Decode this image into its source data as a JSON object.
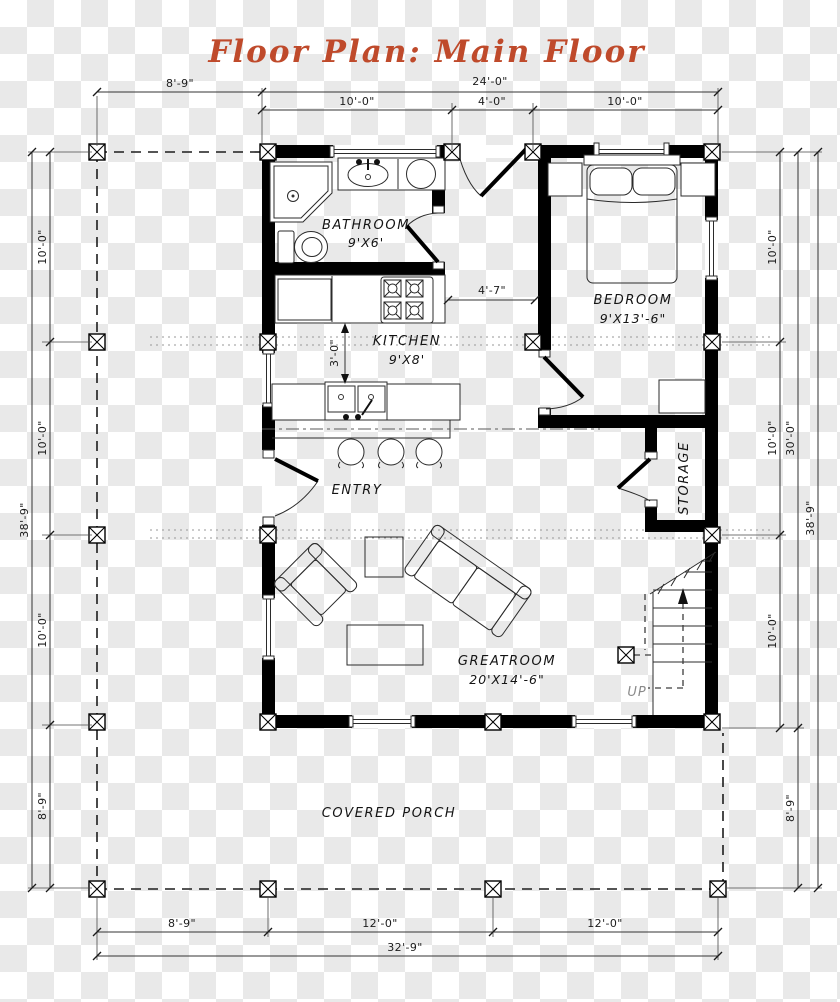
{
  "title": "Floor Plan: Main Floor",
  "colors": {
    "title": "#bf4a2b",
    "wall": "#000000"
  },
  "rooms": {
    "bathroom": {
      "name": "BATHROOM",
      "size": "9'X6'"
    },
    "kitchen": {
      "name": "KITCHEN",
      "size": "9'X8'"
    },
    "bedroom": {
      "name": "BEDROOM",
      "size": "9'X13'-6\""
    },
    "entry": {
      "name": "ENTRY"
    },
    "storage": {
      "name": "STORAGE"
    },
    "greatroom": {
      "name": "GREATROOM",
      "size": "20'X14'-6\""
    },
    "porch": {
      "name": "COVERED PORCH"
    }
  },
  "stairs": {
    "label": "UP"
  },
  "dims": {
    "top_porch": "8'-9\"",
    "top_total": "24'-0\"",
    "top_seg1": "10'-0\"",
    "top_seg2": "4'-0\"",
    "top_seg3": "10'-0\"",
    "hall_width": "4'-7\"",
    "island_clearance": "3'-0\"",
    "left_seg1": "10'-0\"",
    "left_seg2": "10'-0\"",
    "left_seg3": "10'-0\"",
    "left_porch": "8'-9\"",
    "left_total": "38'-9\"",
    "right_seg1": "10'-0\"",
    "right_seg2": "10'-0\"",
    "right_seg3": "10'-0\"",
    "right_house": "30'-0\"",
    "right_porch": "8'-9\"",
    "right_total": "38'-9\"",
    "bottom_seg1": "8'-9\"",
    "bottom_seg2": "12'-0\"",
    "bottom_seg3": "12'-0\"",
    "bottom_total": "32'-9\""
  }
}
